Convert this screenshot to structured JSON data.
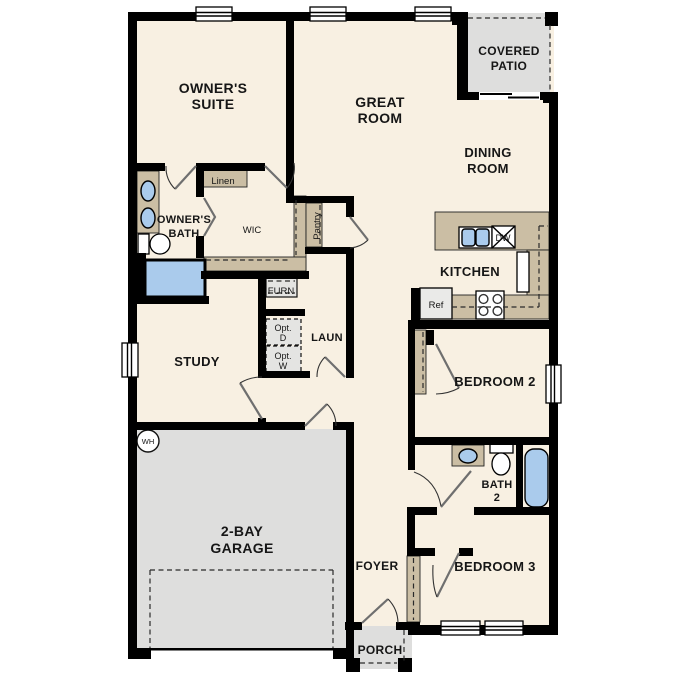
{
  "plan": {
    "rooms": {
      "owners_suite": [
        "OWNER'S",
        "SUITE"
      ],
      "great_room": [
        "GREAT",
        "ROOM"
      ],
      "covered_patio": [
        "COVERED",
        "PATIO"
      ],
      "dining_room": [
        "DINING",
        "ROOM"
      ],
      "owners_bath": [
        "OWNER'S",
        "BATH"
      ],
      "wic": "WIC",
      "linen": "Linen",
      "pantry": "Pantry",
      "kitchen": "KITCHEN",
      "laundry": "LAUN",
      "study": "STUDY",
      "bedroom2": "BEDROOM 2",
      "bath2": [
        "BATH",
        "2"
      ],
      "bedroom3": "BEDROOM 3",
      "garage": [
        "2-BAY",
        "GARAGE"
      ],
      "foyer": "FOYER",
      "porch": "PORCH"
    },
    "fixtures": {
      "furnace": "FURN",
      "opt_dryer": [
        "Opt.",
        "D"
      ],
      "opt_washer": [
        "Opt.",
        "W"
      ],
      "refrigerator": "Ref",
      "dishwasher": "DW",
      "water_heater": "WH"
    },
    "colors": {
      "floor": "#F8F0E2",
      "cabinet_tan": "#CBBEA4",
      "concrete_gray": "#DEDEDD",
      "fixture_blue": "#AACBEC",
      "wall": "#000000"
    }
  }
}
